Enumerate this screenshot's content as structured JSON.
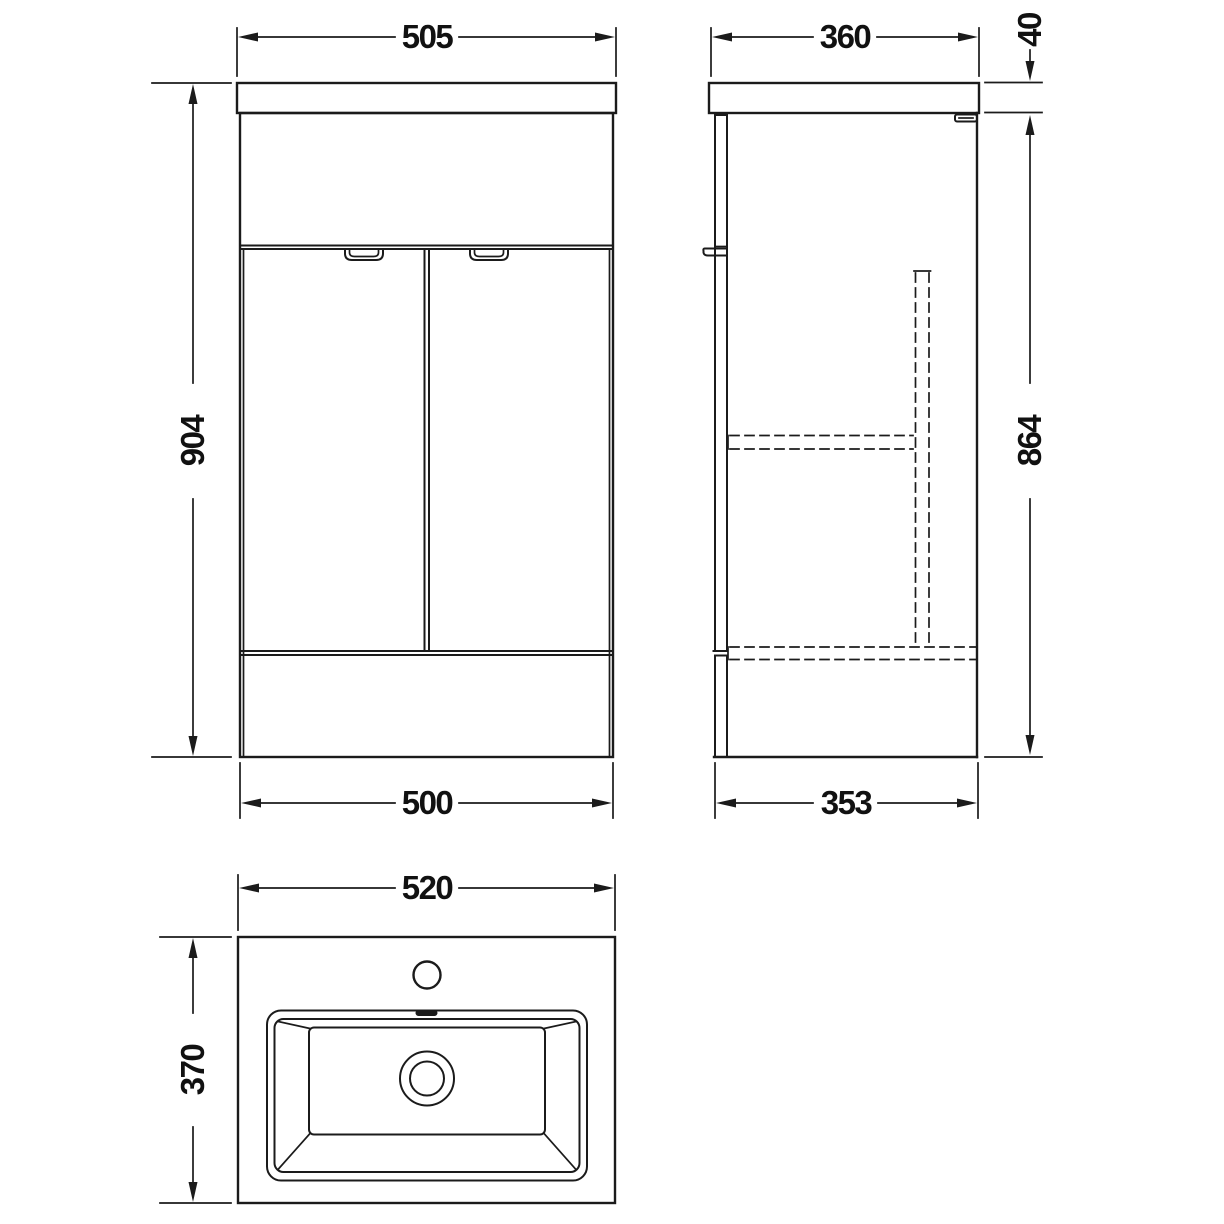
{
  "page": {
    "background": "#ffffff",
    "line_color": "#1b1b1b",
    "description": "Technical dimension drawing of a floor-standing vanity unit with basin: front elevation, side elevation and basin plan view"
  },
  "views": {
    "front": {
      "name": "front-elevation",
      "dims": {
        "top_width": "505",
        "height": "904",
        "bottom_width": "500"
      }
    },
    "side": {
      "name": "side-elevation",
      "dims": {
        "top_depth": "360",
        "worktop_thickness": "40",
        "cabinet_height": "864",
        "bottom_depth": "353"
      }
    },
    "basin_plan": {
      "name": "basin-plan-view",
      "dims": {
        "width": "520",
        "depth": "370"
      }
    }
  }
}
